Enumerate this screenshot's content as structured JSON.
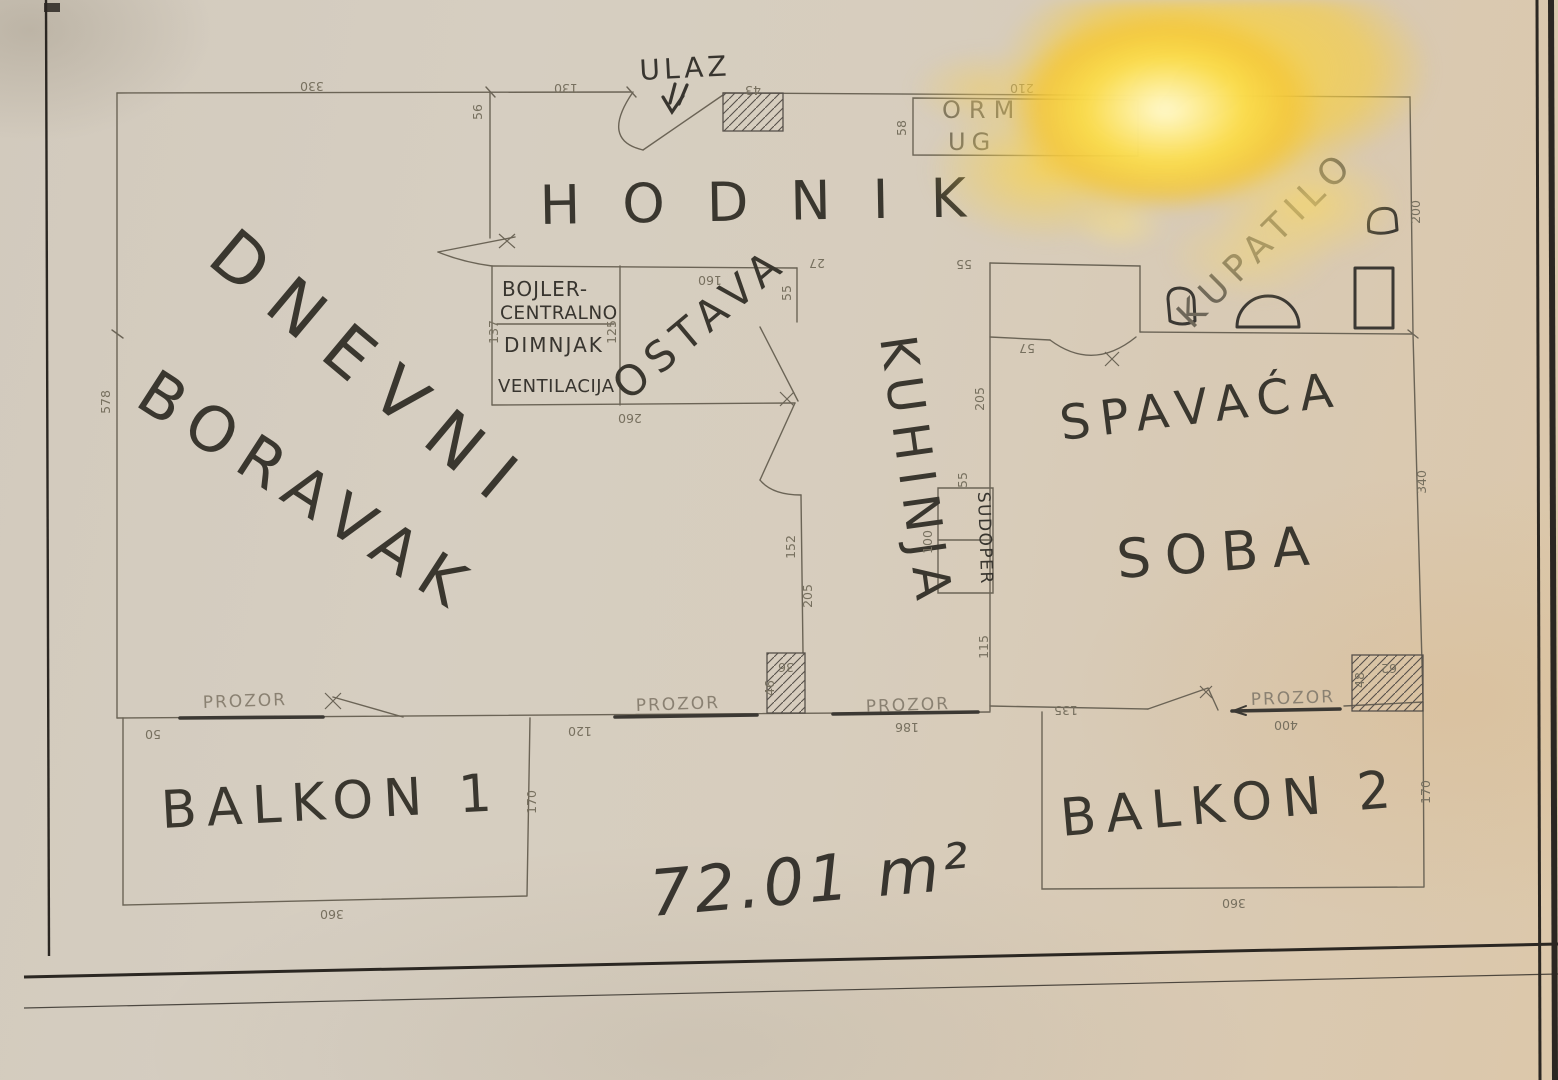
{
  "labels": {
    "ulaz": "ULAZ",
    "hodnik": "HODNIK",
    "dnevni_line1": "DNEVNI",
    "dnevni_line2": "BORAVAK",
    "ostava": "OSTAVA",
    "kuhinja": "KUHINJA",
    "spavaca_line1": "SPAVAĆA",
    "spavaca_line2": "SOBA",
    "kupatilo": "KUPATILO",
    "balkon1": "BALKON 1",
    "balkon2": "BALKON 2",
    "sudoper": "SUDOPER",
    "ormar_line1": "ORM",
    "ormar_line2": "UG",
    "bojler_line1": "BOJLER-",
    "bojler_line2": "CENTRALNO",
    "bojler_line3": "DIMNJAK",
    "bojler_line4": "VENTILACIJA",
    "area": "72.01 m²",
    "prozor1": "PROZOR",
    "prozor2": "PROZOR",
    "prozor3": "PROZOR",
    "prozor4": "PROZOR"
  },
  "dims": {
    "top_living": "330",
    "top_hall": "130",
    "entry_door": "43",
    "wardrobe_width": "210",
    "wardrobe_depth": "58",
    "entry_wall": "56",
    "left_wall": "578",
    "boiler_left": "137",
    "boiler_right": "125",
    "pantry_bottom": "260",
    "pantry_top": "160",
    "pantry_right": "55",
    "corner": "27",
    "hall_seg": "55",
    "kitchen_wall_upper": "205",
    "sink_top": "55",
    "sink_side": "100",
    "kitchen_wall_lower": "115",
    "kitchen_west_upper": "152",
    "kitchen_west_lower": "205",
    "shaft1_top": "36",
    "shaft1_side": "46",
    "bedroom_door": "57",
    "bath_right": "200",
    "bedroom_right": "340",
    "bedroom_seg": "135",
    "bedroom_window": "400",
    "shaft2_top": "62",
    "shaft2_side": "48",
    "balcony2_right": "170",
    "balcony2_bottom": "360",
    "balcony1_left": "50",
    "balcony1_right": "170",
    "balcony1_bottom": "360",
    "living_window_seg": "120",
    "kitchen_window": "186"
  },
  "colors": {
    "ink": "#38352f",
    "pencil": "#77705f",
    "glare": "#f6d245",
    "paper": "#d6cec1"
  }
}
